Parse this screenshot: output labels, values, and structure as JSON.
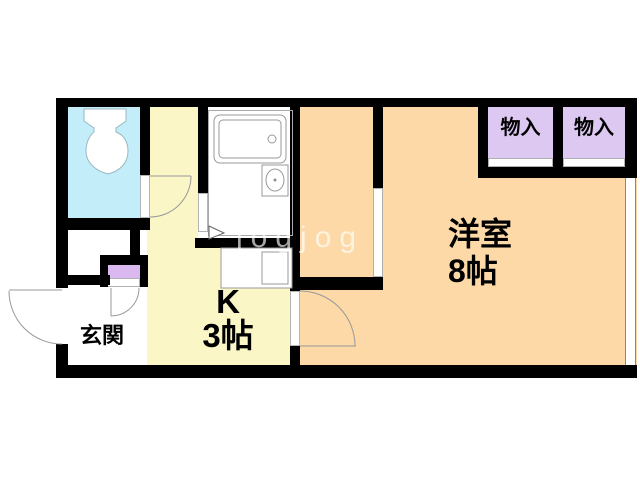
{
  "watermark": "jogjog",
  "rooms": {
    "western": {
      "name": "洋室",
      "size": "8帖"
    },
    "kitchen": {
      "name": "K",
      "size": "3帖"
    },
    "entrance": {
      "name": "玄関"
    },
    "closet_left": {
      "name": "物入"
    },
    "closet_right": {
      "name": "物入"
    }
  },
  "fixtures": {
    "toilet": "toilet-top-view",
    "bathtub": "bathtub-top-view",
    "washbasin": "oval-washbasin",
    "kitchen_counter": "counter-with-sink",
    "shoe_cabinet": "shoe-cabinet",
    "window": "sliding-window",
    "doors": [
      "entrance-swing-door",
      "toilet-swing-door",
      "bathroom-door",
      "room-swing-door",
      "cabinet-swing-door",
      "closet-sliding-door",
      "column-sliding-door"
    ]
  },
  "colors": {
    "wall": "#000000",
    "toilet_floor": "#c3eef9",
    "kitchen_floor": "#fbf6c6",
    "room_floor": "#fcd9a6",
    "closet_fill": "#ddc8f1",
    "cabinet_fill": "#d9b9ef",
    "fixture_stroke": "#999999"
  }
}
